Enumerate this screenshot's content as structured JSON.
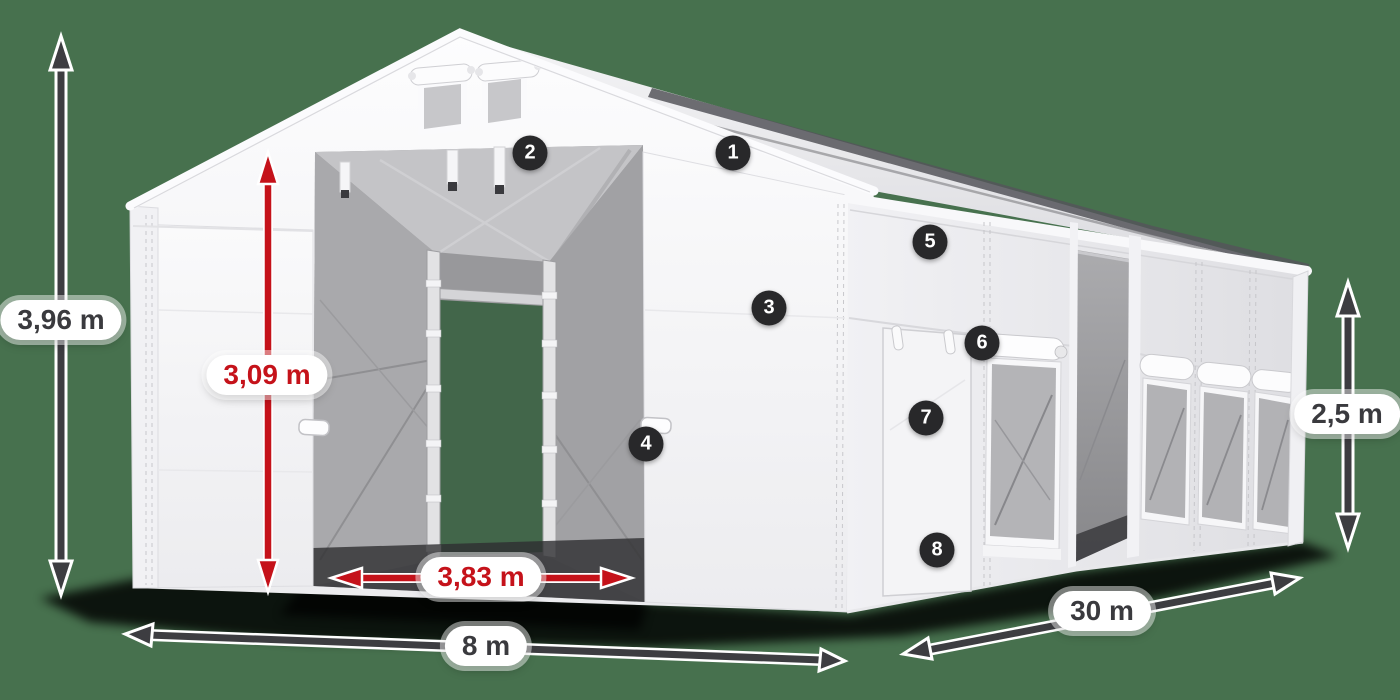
{
  "illustration": {
    "subject": "white storage tent with open gable entrance, side door and mesh windows",
    "background_color": "#47714e"
  },
  "dimension_labels": {
    "total_height": "3,96 m",
    "entrance_height": "3,09 m",
    "entrance_width": "3,83 m",
    "tent_width": "8 m",
    "tent_length": "30 m",
    "side_wall_height": "2,5 m"
  },
  "feature_callouts": [
    {
      "number": "1"
    },
    {
      "number": "2"
    },
    {
      "number": "3"
    },
    {
      "number": "4"
    },
    {
      "number": "5"
    },
    {
      "number": "6"
    },
    {
      "number": "7"
    },
    {
      "number": "8"
    }
  ],
  "colors": {
    "background": "#47714e",
    "arrow_dark": "#3d3d41",
    "arrow_red": "#c5121a",
    "badge_background": "#28282a",
    "badge_text": "#ffffff",
    "label_background": "#ffffff",
    "label_text_dark": "#3a3a3e",
    "label_text_red": "#c5121a",
    "tent_white": "#f6f6f8",
    "interior_mesh_gray": "#a9a9ac"
  }
}
